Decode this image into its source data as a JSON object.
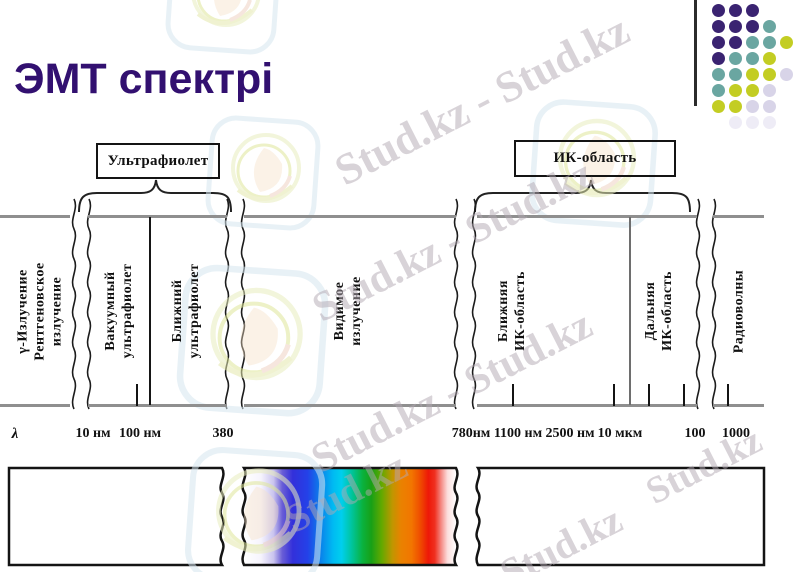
{
  "title": "ЭМТ спектрі",
  "diagram": {
    "top_labels": [
      {
        "text": "Ультрафиолет"
      },
      {
        "text": "ИК-область"
      }
    ],
    "regions": [
      {
        "lines": [
          "γ-Излучение",
          "Рентгеновское",
          "излучение"
        ],
        "x": 40
      },
      {
        "lines": [
          "Вакуумный",
          "ультрафиолет"
        ],
        "x": 119
      },
      {
        "lines": [
          "Ближний",
          "ультрафиолет"
        ],
        "x": 186
      },
      {
        "lines": [
          "Видимое",
          "излучение"
        ],
        "x": 348
      },
      {
        "lines": [
          "Ближняя",
          "ИК-область"
        ],
        "x": 512
      },
      {
        "lines": [
          "Дальняя",
          "ИК-область"
        ],
        "x": 659
      },
      {
        "lines": [
          "Радиоволны"
        ],
        "x": 739
      }
    ],
    "axis": [
      {
        "text": "λ",
        "x": 15,
        "italic": true
      },
      {
        "text": "10 нм",
        "x": 93
      },
      {
        "text": "100 нм",
        "x": 140
      },
      {
        "text": "380",
        "x": 223
      },
      {
        "text": "780нм",
        "x": 471
      },
      {
        "text": "1100 нм",
        "x": 518
      },
      {
        "text": "2500 нм",
        "x": 570
      },
      {
        "text": "10 мкм",
        "x": 620
      },
      {
        "text": "100",
        "x": 695
      },
      {
        "text": "1000",
        "x": 736
      }
    ],
    "bottom_ticks": [
      136,
      512,
      613,
      648,
      683,
      727
    ],
    "wavy_x": [
      74,
      89,
      227,
      243,
      456,
      474,
      698,
      714
    ]
  },
  "spectrum": {
    "stops": [
      {
        "o": 0,
        "c": "#ffffff"
      },
      {
        "o": 0.08,
        "c": "#f6f4fd"
      },
      {
        "o": 0.14,
        "c": "#c9c3ee"
      },
      {
        "o": 0.18,
        "c": "#6a5ed6"
      },
      {
        "o": 0.23,
        "c": "#3330da"
      },
      {
        "o": 0.3,
        "c": "#2441e8"
      },
      {
        "o": 0.36,
        "c": "#0a80ea"
      },
      {
        "o": 0.42,
        "c": "#00baf2"
      },
      {
        "o": 0.46,
        "c": "#00cfee"
      },
      {
        "o": 0.51,
        "c": "#00c49a"
      },
      {
        "o": 0.56,
        "c": "#0ab23e"
      },
      {
        "o": 0.6,
        "c": "#17a017"
      },
      {
        "o": 0.65,
        "c": "#63a900"
      },
      {
        "o": 0.7,
        "c": "#c09600"
      },
      {
        "o": 0.74,
        "c": "#ea8200"
      },
      {
        "o": 0.79,
        "c": "#f27600"
      },
      {
        "o": 0.83,
        "c": "#ef4e00"
      },
      {
        "o": 0.87,
        "c": "#ee1808"
      },
      {
        "o": 0.9,
        "c": "#ef3020"
      },
      {
        "o": 0.93,
        "c": "#f58a84"
      },
      {
        "o": 0.96,
        "c": "#fcdedd"
      },
      {
        "o": 1,
        "c": "#ffffff"
      }
    ]
  },
  "decor": {
    "dots": {
      "dx": 17,
      "dy": 16,
      "palette": {
        "P": "#3a2371",
        "T": "#6aa6a1",
        "Y": "#c3cd23",
        "L": "#d8d4e8",
        "G": "#eeecf6"
      },
      "rows": [
        "PPP..",
        "PPPT.",
        "PPTTY",
        "PTTY.",
        "TTYYL",
        "TYYL.",
        "YYLL.",
        ".GGG."
      ]
    }
  },
  "watermarks": [
    {
      "text": "Stud.kz - Stud.kz",
      "x": 482,
      "y": 100,
      "size": 44
    },
    {
      "text": "Stud.kz - Stud.kz",
      "x": 453,
      "y": 241,
      "size": 42
    },
    {
      "text": "Stud.kz - Stud.kz",
      "x": 452,
      "y": 392,
      "size": 42
    },
    {
      "text": "Stud.kz",
      "x": 346,
      "y": 492,
      "size": 40
    },
    {
      "text": "Stud.kz",
      "x": 704,
      "y": 466,
      "size": 38
    },
    {
      "text": "Stud.kz",
      "x": 561,
      "y": 546,
      "size": 40
    }
  ]
}
